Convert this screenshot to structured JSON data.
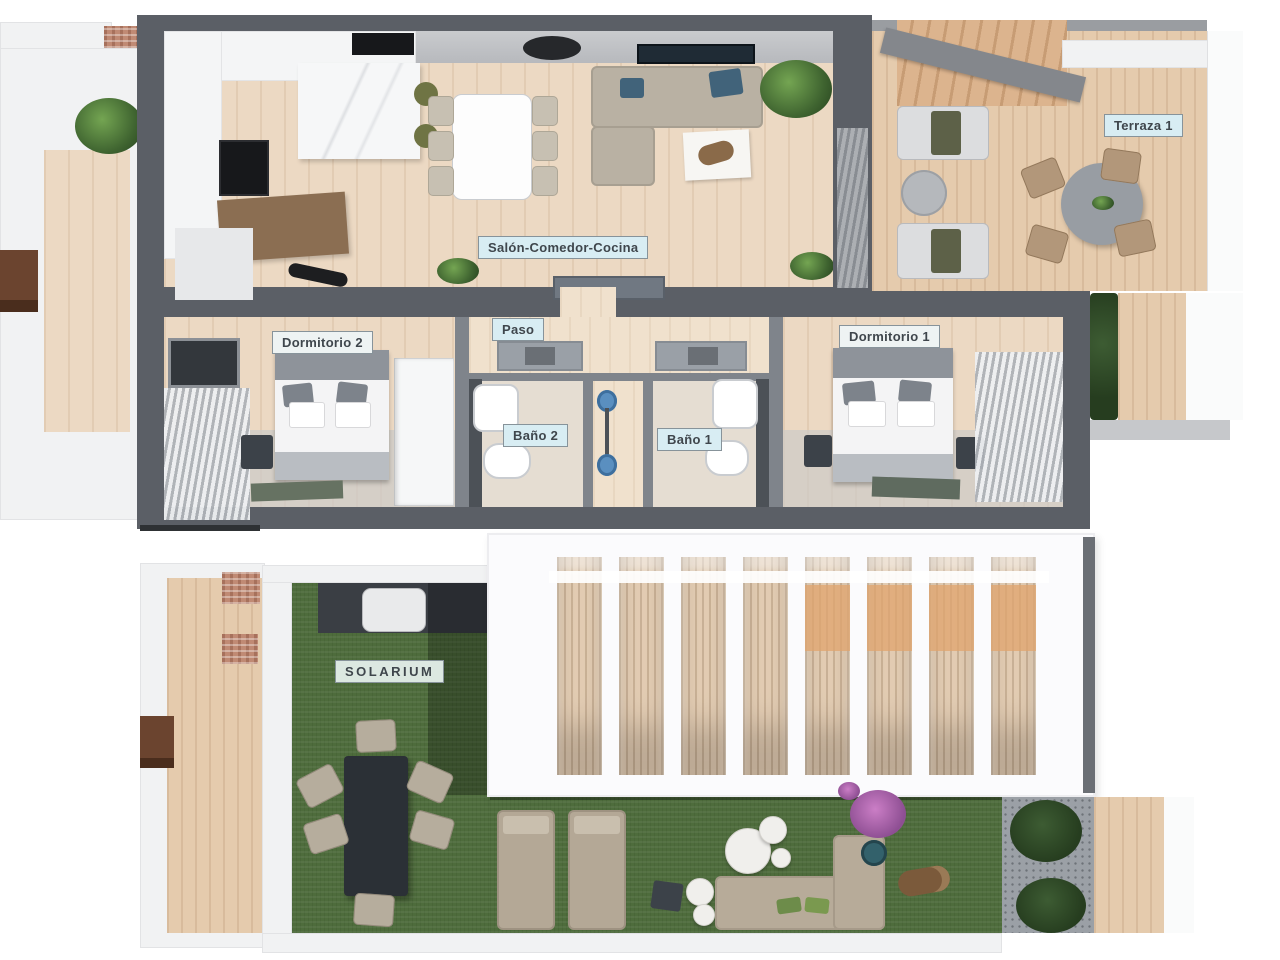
{
  "floors": {
    "upper": {
      "rooms": {
        "salon": {
          "label": "Salón-Comedor-Cocina"
        },
        "terraza1": {
          "label": "Terraza 1"
        },
        "dormitorio2": {
          "label": "Dormitorio 2"
        },
        "paso": {
          "label": "Paso"
        },
        "bano2": {
          "label": "Baño 2"
        },
        "bano1": {
          "label": "Baño 1"
        },
        "dormitorio1": {
          "label": "Dormitorio 1"
        }
      }
    },
    "lower": {
      "rooms": {
        "solarium": {
          "label": "SOLARIUM"
        }
      }
    }
  },
  "colors": {
    "wall_dark": "#5b5f66",
    "wall_inner": "#7f848b",
    "floor_wood": "#ecd9c3",
    "deck_wood": "#e5cbad",
    "label_bg_blue": "#d8edf3",
    "label_bg_light": "#eef3f3",
    "label_text": "#3f464c",
    "turf_green": "#4e6c3c",
    "sofa_beige": "#b9b1a3",
    "pillow_blue": "#41637a",
    "counter_wood": "#8b6e52",
    "appliance_black": "#17181b",
    "gravel_gray": "#9ba0a6"
  }
}
